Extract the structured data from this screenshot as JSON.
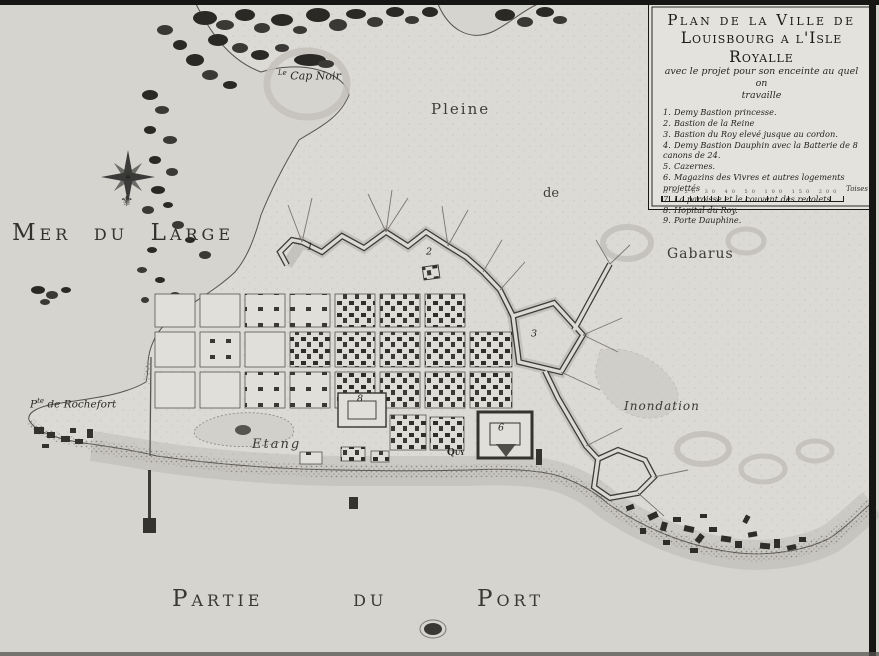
{
  "colors": {
    "paper": "#d6d4cf",
    "land": "#dcdad4",
    "ink": "#2e2c29"
  },
  "cartouche": {
    "title_line1": "Plan de la Ville de",
    "title_line2": "Louisbourg a l'Isle Royalle",
    "subtitle_line1": "avec le projet pour son enceinte au quel on",
    "subtitle_line2": "travaille",
    "legend": [
      {
        "num": "1.",
        "label": "Demy Bastion princesse."
      },
      {
        "num": "2.",
        "label": "Bastion de la Reine"
      },
      {
        "num": "3.",
        "label": "Bastion du Roy elevé jusque au cordon."
      },
      {
        "num": "4.",
        "label": "Demy Bastion Dauphin avec la Batterie de 8 canons de 24."
      },
      {
        "num": "5.",
        "label": "Cazernes."
      },
      {
        "num": "6.",
        "label": "Magazins des Vivres et autres logements projettés"
      },
      {
        "num": "7.",
        "label": "La paroisse et le couvent des recolets"
      },
      {
        "num": "8.",
        "label": "Hopital du Roy."
      },
      {
        "num": "9.",
        "label": "Porte Dauphine."
      }
    ],
    "scale": {
      "ticks": "10 20 30 40 50 100 150 200",
      "unit": "Toises"
    }
  },
  "sea_labels": {
    "mer": [
      "Mer",
      "du",
      "Large"
    ],
    "port": [
      "Partie",
      "du",
      "Port"
    ]
  },
  "place_labels": {
    "pleine": "Pleine",
    "de": "de",
    "gabarus": "Gabarus",
    "cap_noir_prefix": "Le",
    "cap_noir": "Cap Noir",
    "rochefort_p": "P",
    "rochefort_sup": "te",
    "rochefort_rest": " de Rochefort",
    "etang": "Etang",
    "quay": "Quy",
    "inondation": "Inondation"
  },
  "map_markers": [
    {
      "n": "1",
      "x": 310,
      "y": 247
    },
    {
      "n": "2",
      "x": 429,
      "y": 252
    },
    {
      "n": "3",
      "x": 534,
      "y": 334
    },
    {
      "n": "6",
      "x": 501,
      "y": 428
    },
    {
      "n": "8",
      "x": 360,
      "y": 399
    }
  ],
  "compass": {
    "fleur_glyph": "⚜"
  }
}
